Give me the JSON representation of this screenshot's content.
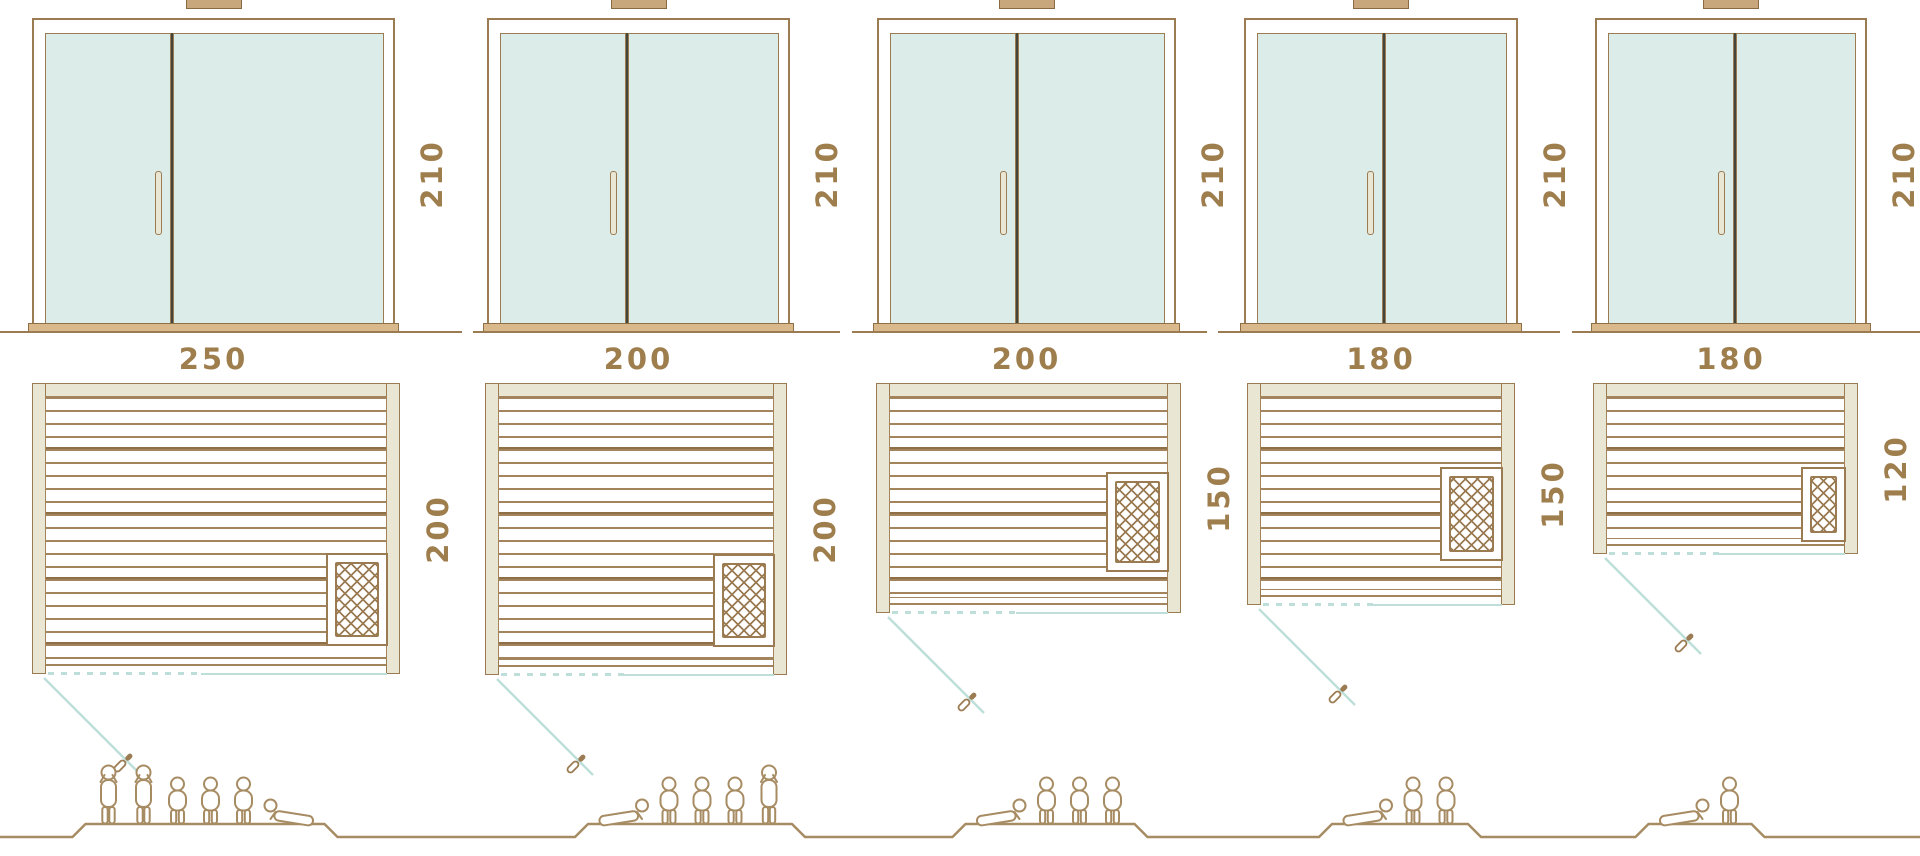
{
  "title": "Sauna sizes diagram",
  "door_type": "double-glass-door-elevation",
  "units": [
    {
      "id": "sauna-250x200",
      "door_height_cm": "210",
      "width_cm": "250",
      "depth_cm": "200",
      "capacity": {
        "standing": 2,
        "sitting": 3,
        "lying": 1
      },
      "figures": [
        "stand",
        "stand",
        "sit",
        "sit",
        "sit",
        "lie"
      ]
    },
    {
      "id": "sauna-200x200",
      "door_height_cm": "210",
      "width_cm": "200",
      "depth_cm": "200",
      "capacity": {
        "standing": 1,
        "sitting": 3,
        "lying": 1
      },
      "figures": [
        "lie",
        "sit",
        "sit",
        "sit",
        "stand"
      ]
    },
    {
      "id": "sauna-200x150",
      "door_height_cm": "210",
      "width_cm": "200",
      "depth_cm": "150",
      "capacity": {
        "standing": 0,
        "sitting": 3,
        "lying": 1
      },
      "figures": [
        "lie",
        "sit",
        "sit",
        "sit"
      ]
    },
    {
      "id": "sauna-180x150",
      "door_height_cm": "210",
      "width_cm": "180",
      "depth_cm": "150",
      "capacity": {
        "standing": 0,
        "sitting": 2,
        "lying": 1
      },
      "figures": [
        "lie",
        "sit",
        "sit"
      ]
    },
    {
      "id": "sauna-180x120",
      "door_height_cm": "210",
      "width_cm": "180",
      "depth_cm": "120",
      "capacity": {
        "standing": 0,
        "sitting": 1,
        "lying": 1
      },
      "figures": [
        "lie",
        "sit"
      ]
    }
  ],
  "colors": {
    "line_brown": "#9b7b52",
    "dark_brown": "#8f6f46",
    "tan_fill": "#e9e6d3",
    "cap_fill": "#c8a77c",
    "glass": "#dcece9",
    "teal": "#bedfd9",
    "text_brown": "#9f7e4e",
    "people": "#a78c63"
  }
}
